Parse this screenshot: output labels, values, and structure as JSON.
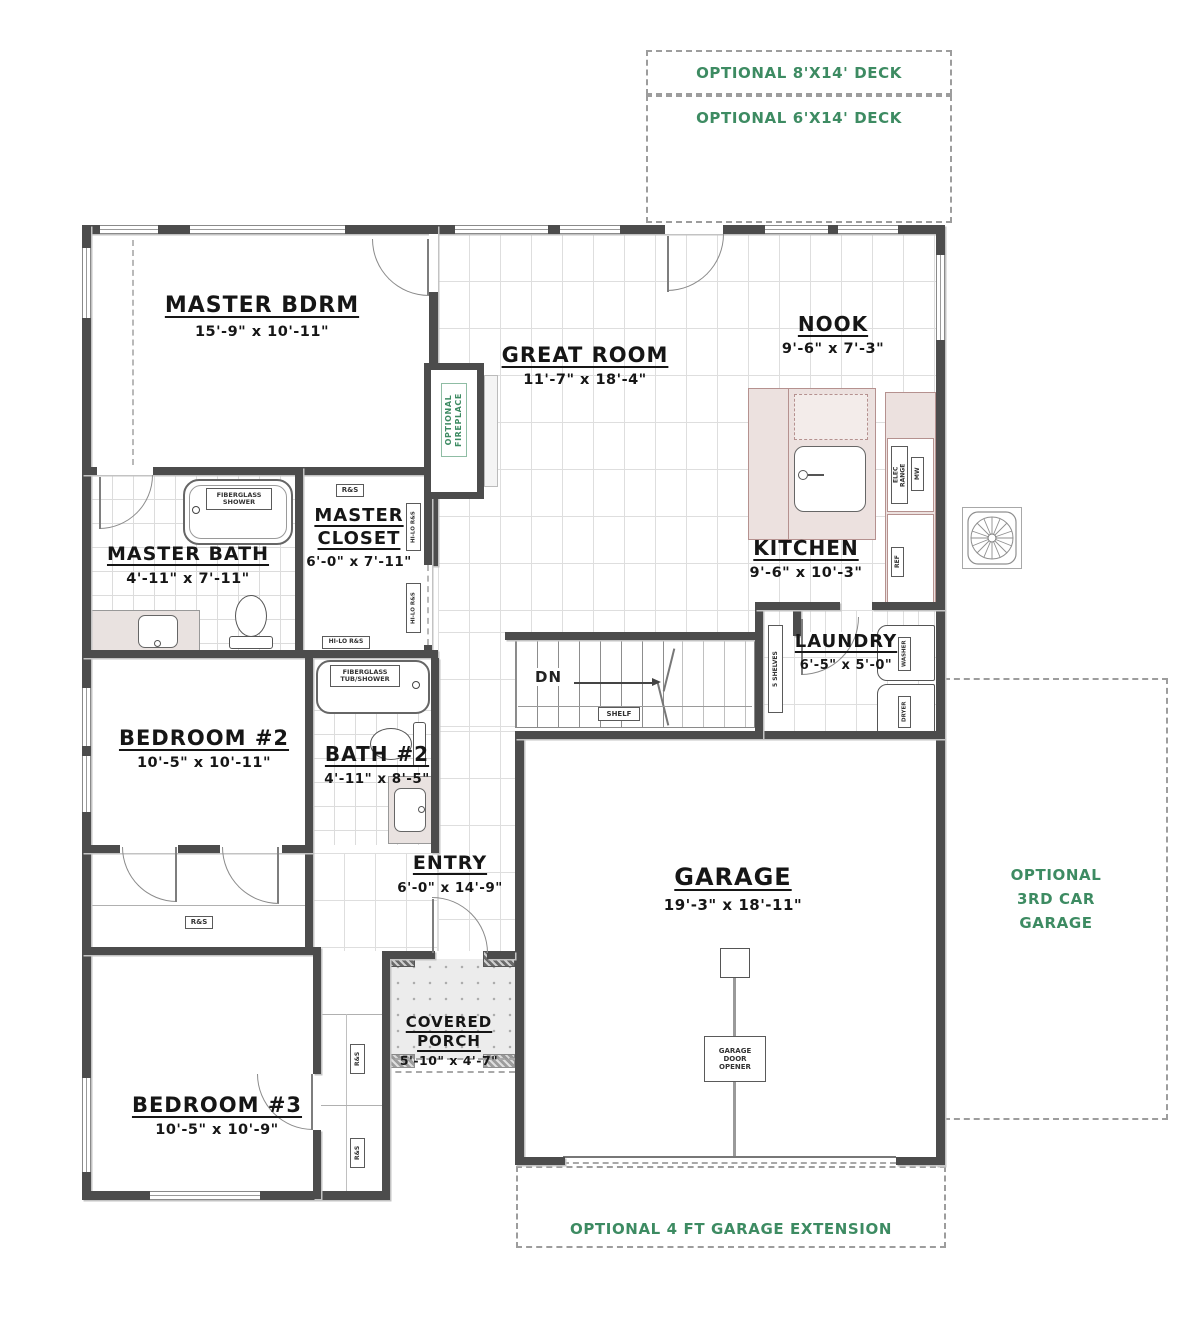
{
  "colors": {
    "wall": "#4c4c4c",
    "accent_green": "#3d8b62",
    "counter_pink": "#ece1df"
  },
  "optional": {
    "deck8": "OPTIONAL 8'X14' DECK",
    "deck6": "OPTIONAL 6'X14' DECK",
    "third_car_garage": "OPTIONAL\n3RD CAR\nGARAGE",
    "garage_extension": "OPTIONAL 4 FT GARAGE EXTENSION",
    "fireplace": "OPTIONAL\nFIREPLACE"
  },
  "rooms": {
    "master_bdrm": {
      "name": "MASTER BDRM",
      "dims": "15'-9\" x 10'-11\""
    },
    "great_room": {
      "name": "GREAT ROOM",
      "dims": "11'-7\" x 18'-4\""
    },
    "nook": {
      "name": "NOOK",
      "dims": "9'-6\" x 7'-3\""
    },
    "kitchen": {
      "name": "KITCHEN",
      "dims": "9'-6\" x 10'-3\""
    },
    "master_bath": {
      "name": "MASTER BATH",
      "dims": "4'-11\" x 7'-11\""
    },
    "master_closet": {
      "name": "MASTER\nCLOSET",
      "dims": "6'-0\" x 7'-11\""
    },
    "laundry": {
      "name": "LAUNDRY",
      "dims": "6'-5\" x 5'-0\""
    },
    "bedroom2": {
      "name": "BEDROOM #2",
      "dims": "10'-5\" x 10'-11\""
    },
    "bath2": {
      "name": "BATH #2",
      "dims": "4'-11\" x 8'-5\""
    },
    "entry": {
      "name": "ENTRY",
      "dims": "6'-0\" x 14'-9\""
    },
    "garage": {
      "name": "GARAGE",
      "dims": "19'-3\" x 18'-11\""
    },
    "covered_porch": {
      "name": "COVERED\nPORCH",
      "dims": "5'-10\" x 4'-7\""
    },
    "bedroom3": {
      "name": "BEDROOM #3",
      "dims": "10'-5\" x 10'-9\""
    }
  },
  "fixtures": {
    "fiberglass_shower": "FIBERGLASS\nSHOWER",
    "fiberglass_tub_shower": "FIBERGLASS\nTUB/SHOWER",
    "elec_range": "ELEC\nRANGE",
    "microwave": "MW",
    "refrigerator": "REF",
    "washer": "WASHER",
    "dryer": "DRYER",
    "pantry_shelves": "5 SHELVES",
    "shelf": "SHELF",
    "stairs_down": "DN",
    "rod_shelf": "R&S",
    "hilo_rod_shelf": "HI-LO R&S",
    "garage_door_opener": "GARAGE\nDOOR\nOPENER"
  }
}
